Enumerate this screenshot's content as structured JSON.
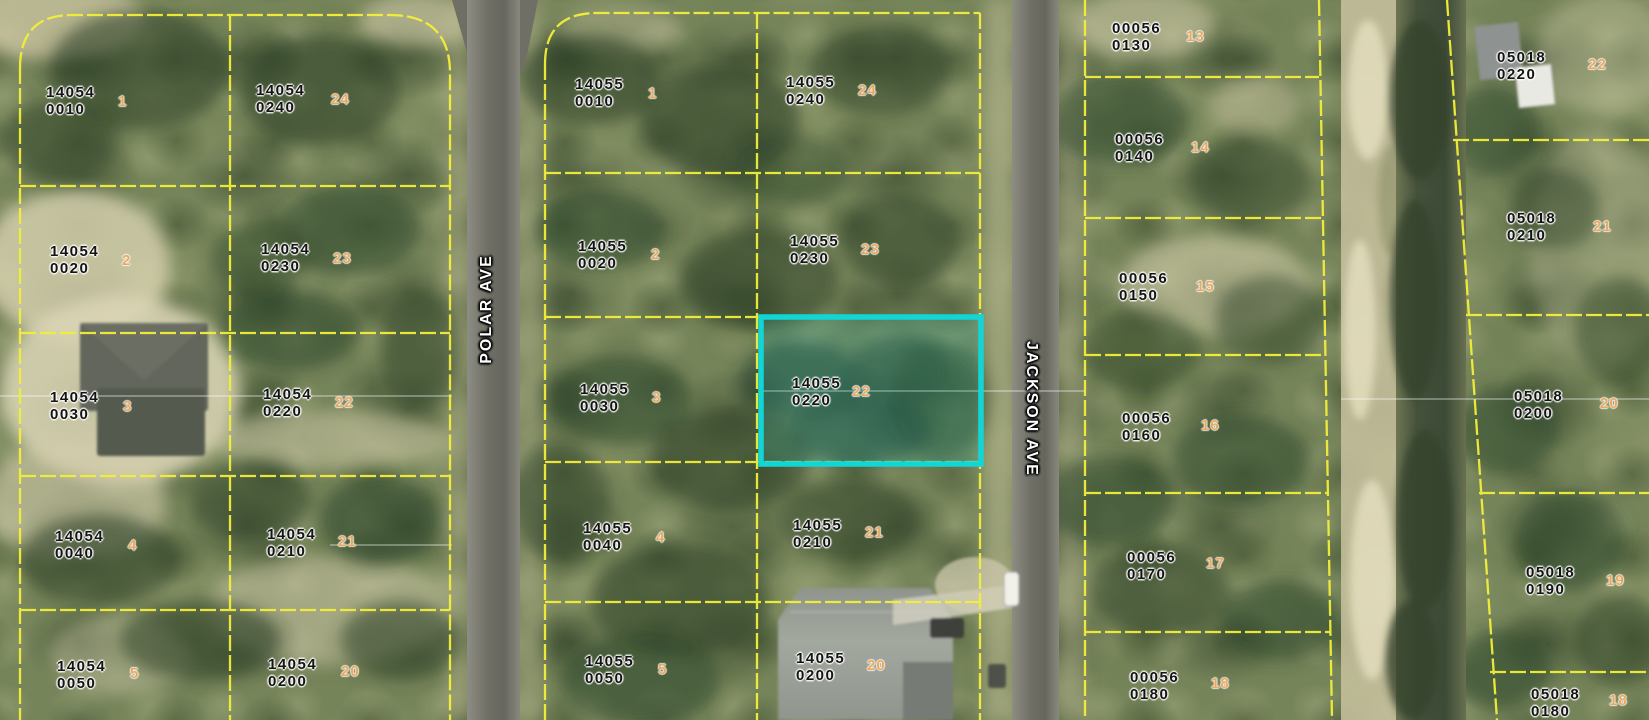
{
  "streets": [
    {
      "name": "POLAR AVE"
    },
    {
      "name": "JACKSON AVE"
    }
  ],
  "highlight": {
    "parcel_id1": "14055",
    "parcel_id2": "0220",
    "lot": "22",
    "color": "#12d6d6"
  },
  "boundary_color": "#f3ef39",
  "parcels": [
    {
      "id1": "14054",
      "id2": "0010",
      "lot": "1"
    },
    {
      "id1": "14054",
      "id2": "0240",
      "lot": "24"
    },
    {
      "id1": "14054",
      "id2": "0020",
      "lot": "2"
    },
    {
      "id1": "14054",
      "id2": "0230",
      "lot": "23"
    },
    {
      "id1": "14054",
      "id2": "0030",
      "lot": "3"
    },
    {
      "id1": "14054",
      "id2": "0220",
      "lot": "22"
    },
    {
      "id1": "14054",
      "id2": "0040",
      "lot": "4"
    },
    {
      "id1": "14054",
      "id2": "0210",
      "lot": "21"
    },
    {
      "id1": "14054",
      "id2": "0050",
      "lot": "5"
    },
    {
      "id1": "14054",
      "id2": "0200",
      "lot": "20"
    },
    {
      "id1": "14055",
      "id2": "0010",
      "lot": "1"
    },
    {
      "id1": "14055",
      "id2": "0240",
      "lot": "24"
    },
    {
      "id1": "14055",
      "id2": "0020",
      "lot": "2"
    },
    {
      "id1": "14055",
      "id2": "0230",
      "lot": "23"
    },
    {
      "id1": "14055",
      "id2": "0030",
      "lot": "3"
    },
    {
      "id1": "14055",
      "id2": "0220",
      "lot": "22",
      "highlighted": true
    },
    {
      "id1": "14055",
      "id2": "0040",
      "lot": "4"
    },
    {
      "id1": "14055",
      "id2": "0210",
      "lot": "21"
    },
    {
      "id1": "14055",
      "id2": "0050",
      "lot": "5"
    },
    {
      "id1": "14055",
      "id2": "0200",
      "lot": "20"
    },
    {
      "id1": "00056",
      "id2": "0130",
      "lot": "13"
    },
    {
      "id1": "00056",
      "id2": "0140",
      "lot": "14"
    },
    {
      "id1": "00056",
      "id2": "0150",
      "lot": "15"
    },
    {
      "id1": "00056",
      "id2": "0160",
      "lot": "16"
    },
    {
      "id1": "00056",
      "id2": "0170",
      "lot": "17"
    },
    {
      "id1": "00056",
      "id2": "0180",
      "lot": "18"
    },
    {
      "id1": "05018",
      "id2": "0220",
      "lot": "22"
    },
    {
      "id1": "05018",
      "id2": "0210",
      "lot": "21"
    },
    {
      "id1": "05018",
      "id2": "0200",
      "lot": "20"
    },
    {
      "id1": "05018",
      "id2": "0190",
      "lot": "19"
    },
    {
      "id1": "05018",
      "id2": "0180",
      "lot": "18"
    }
  ]
}
